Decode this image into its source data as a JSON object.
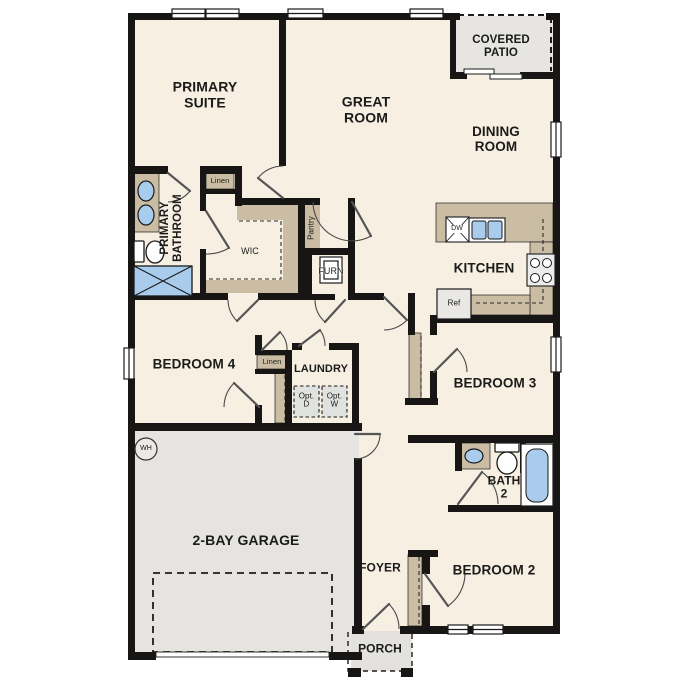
{
  "labels": {
    "primary_suite": "PRIMARY SUITE",
    "great_room": "GREAT ROOM",
    "covered_patio": "COVERED PATIO",
    "dining_room": "DINING ROOM",
    "kitchen": "KITCHEN",
    "primary_bathroom": "PRIMARY BATHROOM",
    "wic": "WIC",
    "linen_bath": "Linen",
    "pantry": "Pantry",
    "furnace": "FURN",
    "bedroom4": "BEDROOM 4",
    "linen_hall": "Linen",
    "laundry": "LAUNDRY",
    "opt_dryer": "Opt.\nD",
    "opt_washer": "Opt.\nW",
    "garage": "2-BAY GARAGE",
    "water_heater": "WH",
    "bedroom3": "BEDROOM 3",
    "bath2": "BATH 2",
    "bedroom2": "BEDROOM 2",
    "foyer": "FOYER",
    "porch": "PORCH",
    "dishwasher": "DW",
    "refrigerator": "Ref"
  },
  "colors": {
    "floor": "#f7efe2",
    "garage_floor": "#e5e4e1",
    "patio_floor": "#e6e5e2",
    "porch_floor": "#e3e2df",
    "cabinet_tan": "#cbbda4",
    "fixture_blue": "#a9cbec",
    "appliance_gray": "#e9e8e5",
    "opt_box_gray": "#e0e2e0",
    "wall": "#171614",
    "text": "#1b1b1a"
  }
}
